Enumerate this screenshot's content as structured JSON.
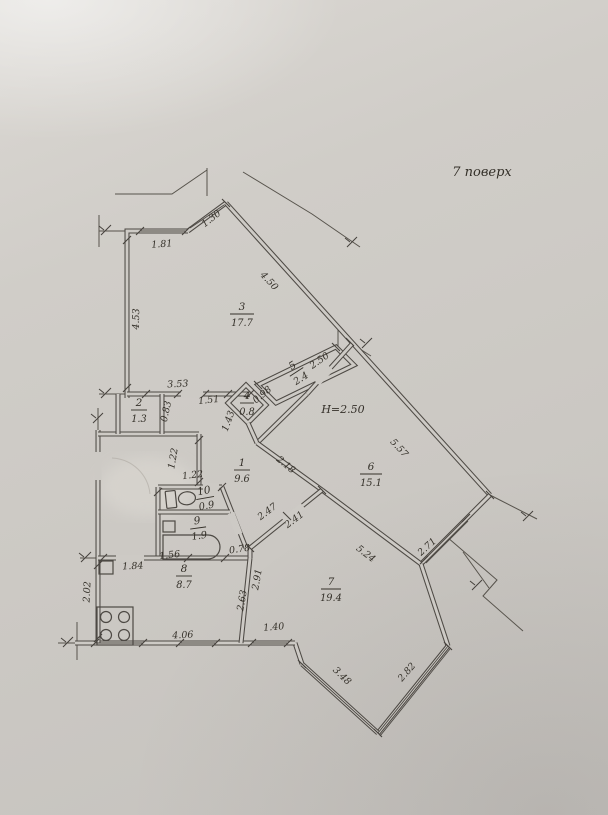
{
  "plan": {
    "floor_label": "7 поверх",
    "height_note": "H=2.50",
    "rooms": {
      "r1": {
        "number": "1",
        "area": "9.6"
      },
      "r2": {
        "number": "2",
        "area": "1.3"
      },
      "r3": {
        "number": "3",
        "area": "17.7"
      },
      "r4": {
        "number": "4",
        "area": "0.8"
      },
      "r5": {
        "number": "5",
        "area": "2.4"
      },
      "r6": {
        "number": "6",
        "area": "15.1"
      },
      "r7": {
        "number": "7",
        "area": "19.4"
      },
      "r8": {
        "number": "8",
        "area": "8.7"
      },
      "r9": {
        "number": "9",
        "area": "1.9"
      },
      "r10": {
        "number": "10",
        "area": "0.9"
      }
    },
    "dims": {
      "d181": "1.81",
      "d130": "1.30",
      "d450": "4.50",
      "d453": "4.53",
      "d353": "3.53",
      "d083": "0.83",
      "d151": "1.51",
      "d143": "1.43",
      "d098": "0.98",
      "d250": "2.50",
      "d557": "5.57",
      "d122_entry": "1.22",
      "d122_wc": "1.22",
      "d218": "2.18",
      "d247": "2.47",
      "d241": "2.41",
      "d078": "0.78",
      "d156": "1.56",
      "d184": "1.84",
      "d202": "2.02",
      "d406": "4.06",
      "d263": "2.63",
      "d291": "2.91",
      "d140": "1.40",
      "d524": "5.24",
      "d271": "2.71",
      "d348": "3.48",
      "d282": "2.82"
    },
    "colors": {
      "ink": "#4d4944",
      "paper": "#cdcac5"
    }
  }
}
